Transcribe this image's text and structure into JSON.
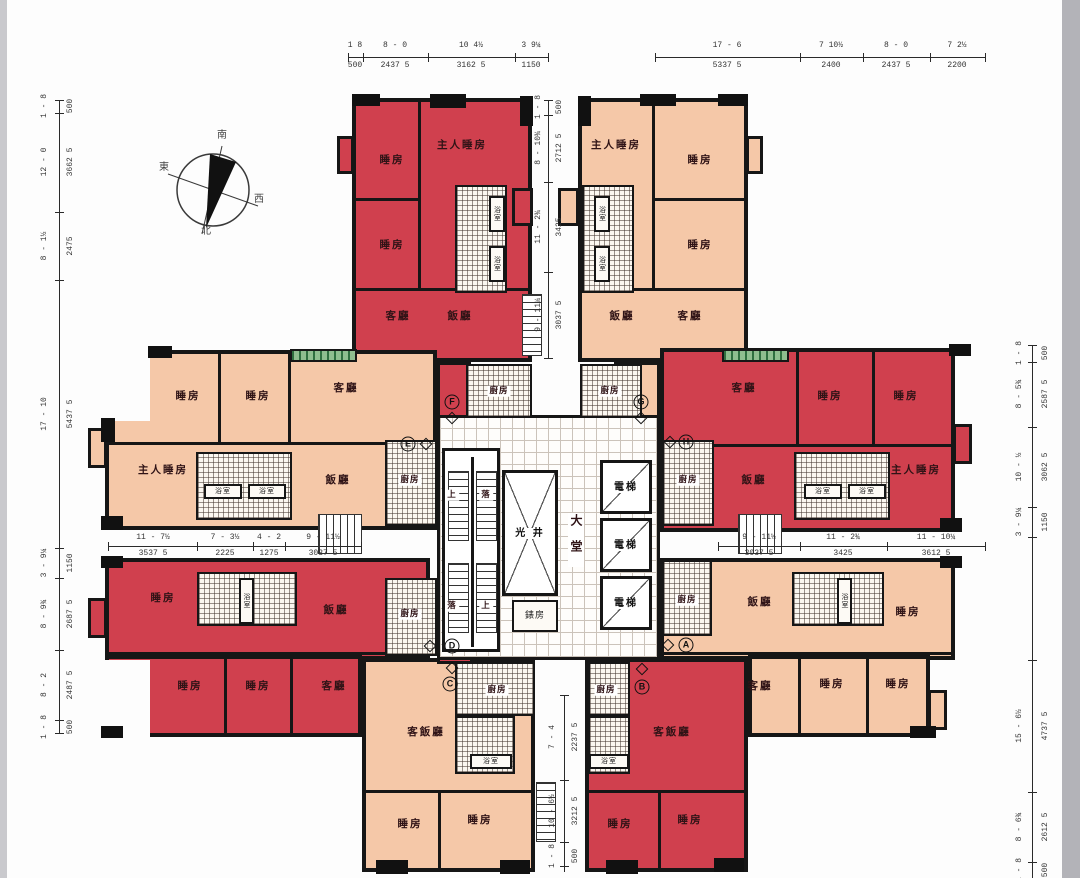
{
  "rooms": {
    "bedroom": "睡房",
    "master_bedroom": "主人睡房",
    "living": "客廳",
    "dining": "飯廳",
    "living_dining": "客飯廳",
    "bath": "浴室",
    "kitchen": "廚房"
  },
  "core": {
    "elevator": "電梯",
    "light_well": "光 井",
    "lobby": "大堂",
    "meter_room": "錶房",
    "up": "上",
    "down": "落"
  },
  "units": {
    "a": "A",
    "b": "B",
    "c": "C",
    "d": "D",
    "e": "E",
    "f": "F",
    "g": "G",
    "h": "H"
  },
  "compass": {
    "north": "北",
    "south": "南",
    "east": "東",
    "west": "西"
  },
  "dims": {
    "top_left": [
      {
        "ft": "1 8",
        "mm": "500"
      },
      {
        "ft": "8 - 0",
        "mm": "2437 5"
      },
      {
        "ft": "10 4½",
        "mm": "3162 5"
      },
      {
        "ft": "3 9¼",
        "mm": "1150"
      }
    ],
    "top_right": [
      {
        "ft": "17 - 6",
        "mm": "5337 5"
      },
      {
        "ft": "7 10½",
        "mm": "2400"
      },
      {
        "ft": "8 - 0",
        "mm": "2437 5"
      },
      {
        "ft": "7 2½",
        "mm": "2200"
      }
    ],
    "left": [
      {
        "ft": "1 - 8",
        "mm": "500"
      },
      {
        "ft": "12 - 0",
        "mm": "3662 5"
      },
      {
        "ft": "8 - 1½",
        "mm": "2475"
      },
      {
        "ft": "17 - 10",
        "mm": "5437 5"
      },
      {
        "ft": "3 - 9¼",
        "mm": "1150"
      },
      {
        "ft": "8 - 9¾",
        "mm": "2687 5"
      },
      {
        "ft": "8 - 2",
        "mm": "2487 5"
      },
      {
        "ft": "1 - 8",
        "mm": "500"
      }
    ],
    "right": [
      {
        "ft": "1 - 8",
        "mm": "500"
      },
      {
        "ft": "8 - 5¾",
        "mm": "2587 5"
      },
      {
        "ft": "10 - ½",
        "mm": "3062 5"
      },
      {
        "ft": "3 - 9¼",
        "mm": "1150"
      },
      {
        "ft": "15 - 6½",
        "mm": "4737 5"
      },
      {
        "ft": "8 - 6¾",
        "mm": "2612 5"
      },
      {
        "ft": "1 - 8",
        "mm": "500"
      }
    ],
    "mid_left": [
      {
        "ft": "11 - 7½",
        "mm": "3537 5"
      },
      {
        "ft": "7 - 3½",
        "mm": "2225"
      },
      {
        "ft": "4 - 2",
        "mm": "1275"
      },
      {
        "ft": "9 - 11½",
        "mm": "3037 5"
      }
    ],
    "mid_right": [
      {
        "ft": "9 - 11½",
        "mm": "3037 5"
      },
      {
        "ft": "11 - 2¾",
        "mm": "3425"
      },
      {
        "ft": "11 - 10¼",
        "mm": "3612 5"
      }
    ],
    "center_top": [
      {
        "ft": "1 - 8",
        "mm": "500"
      },
      {
        "ft": "8 - 10¾",
        "mm": "2712 5"
      },
      {
        "ft": "11 - 2¾",
        "mm": "3425"
      },
      {
        "ft": "9 - 11¼",
        "mm": "3037 5"
      }
    ],
    "center_bottom": [
      {
        "ft": "7 - 4",
        "mm": "2237 5"
      },
      {
        "ft": "10 - 6½",
        "mm": "3212 5"
      },
      {
        "ft": "1 - 8",
        "mm": "500"
      }
    ]
  }
}
